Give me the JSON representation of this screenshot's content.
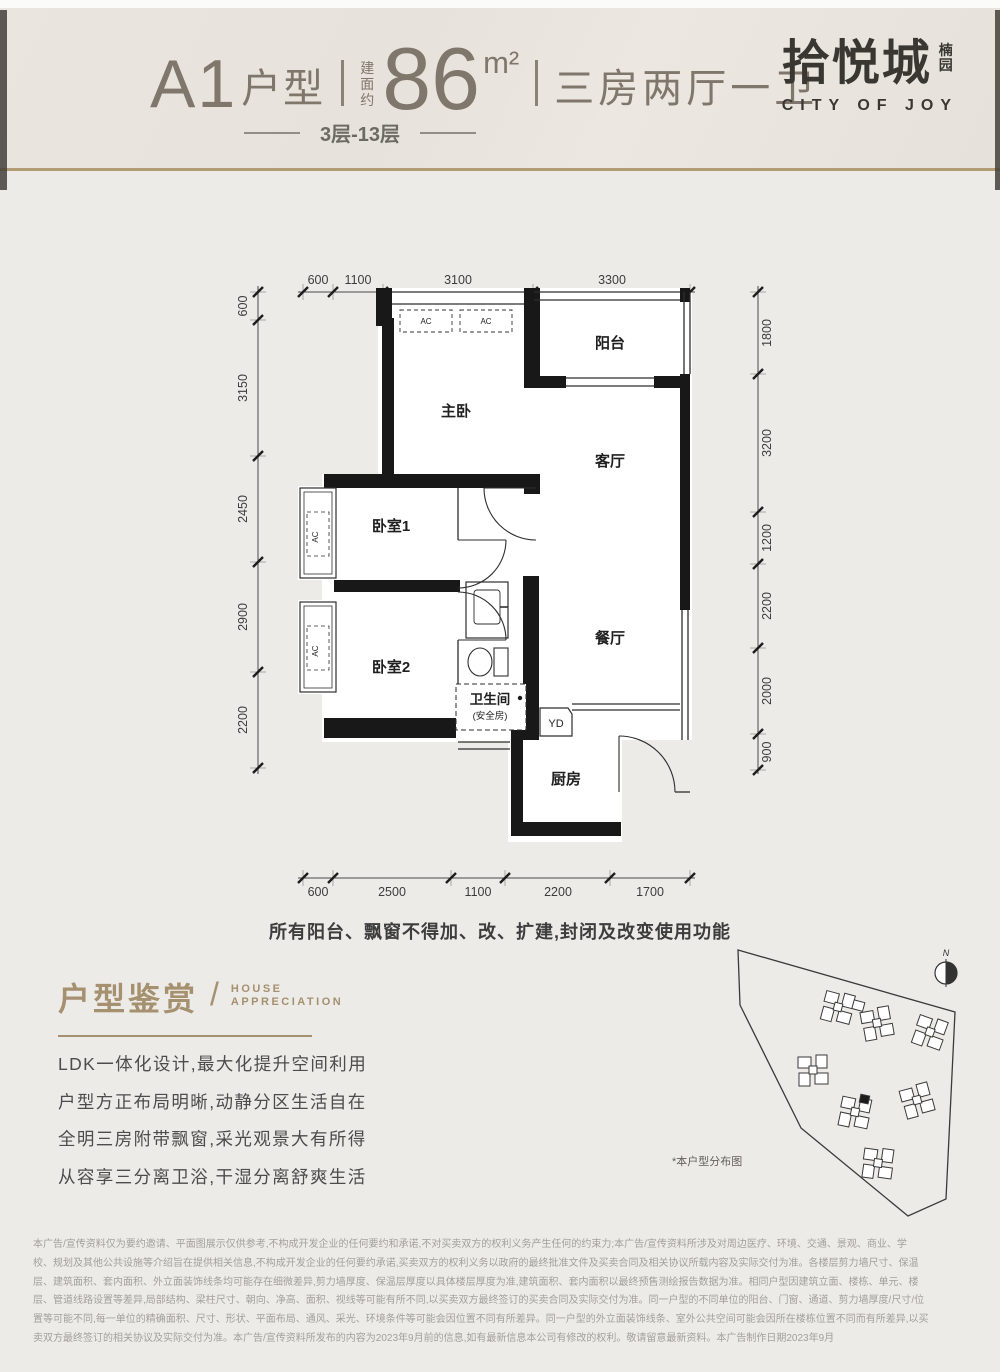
{
  "header": {
    "unit_code": "A1",
    "unit_word": "户型",
    "area_prefix": "建面约",
    "area_value": "86",
    "area_unit": "m²",
    "layout_text": "三房两厅一卫",
    "floors_text": "3层-13层",
    "brand_cn": "拾悦城",
    "brand_seal": "楠园",
    "brand_en": "CITY OF JOY"
  },
  "floorplan": {
    "rooms": {
      "master": "主卧",
      "balcony": "阳台",
      "living": "客厅",
      "bed1": "卧室1",
      "dining": "餐厅",
      "bed2": "卧室2",
      "bath": "卫生间",
      "bath_note": "(安全房)",
      "yd": "YD",
      "kitchen": "厨房"
    },
    "ac": "AC",
    "dims": {
      "top": [
        "600",
        "1100",
        "3100",
        "3300"
      ],
      "bottom": [
        "600",
        "2500",
        "1100",
        "2200",
        "1700"
      ],
      "left": [
        "600",
        "3150",
        "2450",
        "2900",
        "2200"
      ],
      "right": [
        "1800",
        "3200",
        "1200",
        "2200",
        "2000",
        "900"
      ]
    },
    "note": "所有阳台、飘窗不得加、改、扩建,封闭及改变使用功能"
  },
  "appreciation": {
    "title": "户型鉴赏",
    "en_line1": "HOUSE",
    "en_line2": "APPRECIATION",
    "lines": [
      "LDK一体化设计,最大化提升空间利用",
      "户型方正布局明晰,动静分区生活自在",
      "全明三房附带飘窗,采光观景大有所得",
      "从容享三分离卫浴,干湿分离舒爽生活"
    ]
  },
  "siteplan": {
    "caption": "*本户型分布图",
    "north": "N"
  },
  "disclaimer": {
    "lines": [
      "本广告/宣传资料仅为要约邀请、平面图展示仅供参考,不构成开发企业的任何要约和承诺,不对买卖双方的权利义务产生任何的约束力;本广告/宣传资料所涉及对周边医疗、环境、交通、景观、商业、学",
      "校、规划及其他公共设施等介绍旨在提供相关信息,不构成开发企业的任何要约承诺,买卖双方的权利义务以政府的最终批准文件及买卖合同及相关协议所载内容及实际交付为准。各楼层剪力墙尺寸、保温",
      "层、建筑面积、套内面积、外立面装饰线条均可能存在细微差异,剪力墙厚度、保温层厚度以具体楼层厚度为准,建筑面积、套内面积以最终预售测绘报告数据为准。相同户型因建筑立面、楼栋、单元、楼",
      "层、管道线路设置等差异,局部结构、梁柱尺寸、朝向、净高、面积、视线等可能有所不同,以买卖双方最终签订的买卖合同及实际交付为准。同一户型的不同单位的阳台、门窗、通道、剪力墙厚度/尺寸/位",
      "置等可能不同,每一单位的精确面积、尺寸、形状、平面布局、通风、采光、环境条件等可能会因位置不同有所差异。同一户型的外立面装饰线条、室外公共空间可能会因所在楼栋位置不同而有所差异,以买",
      "卖双方最终签订的相关协议及实际交付为准。本广告/宣传资料所发布的内容为2023年9月前的信息,如有最新信息本公司有修改的权利。敬请留意最新资料。本广告制作日期2023年9月"
    ]
  }
}
